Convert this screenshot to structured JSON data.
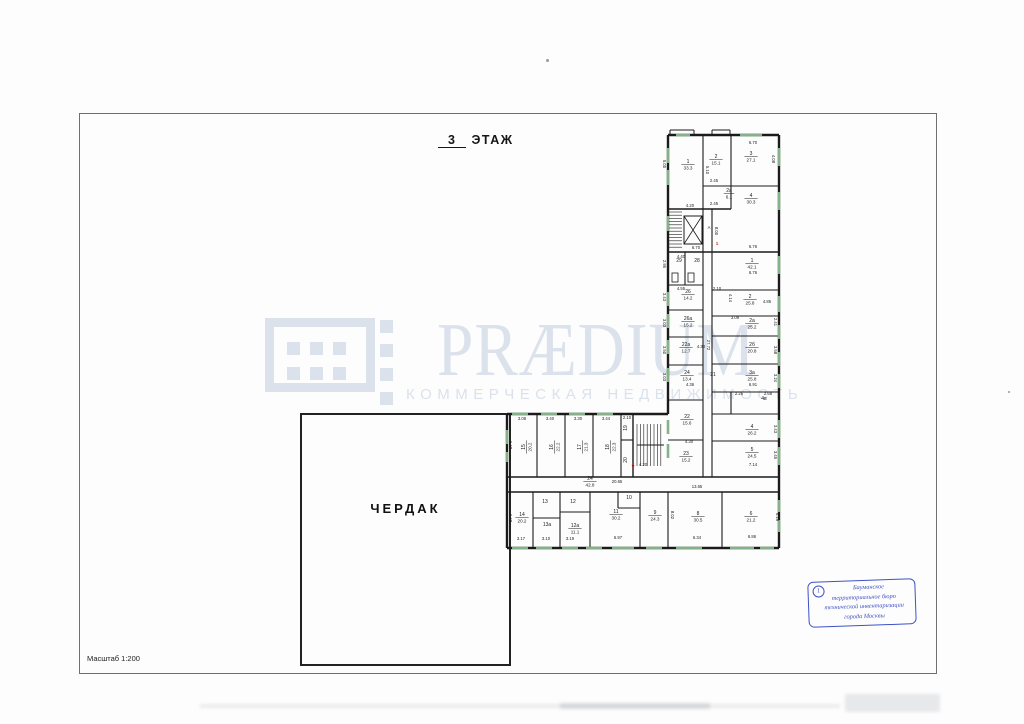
{
  "page": {
    "title_floor": "3",
    "title_word": "ЭТАЖ",
    "scale_label": "Масштаб 1:200",
    "attic_label": "ЧЕРДАК"
  },
  "watermark": {
    "brand": "PRÆDIUM",
    "tagline": "КОММЕРЧЕСКАЯ НЕДВИЖИМОСТЬ",
    "color": "#dbe2ec"
  },
  "stamp": {
    "number": "1",
    "lines": [
      "Бауманское",
      "территориальное бюро",
      "технической инвентаризации",
      "города Москвы"
    ],
    "color": "#3f51c5"
  },
  "plan": {
    "wall_color": "#1b1b1b",
    "window_color": "#86b28a",
    "accent_red": "#c63030",
    "walls": [
      [
        668,
        135,
        779,
        135,
        2.4
      ],
      [
        779,
        135,
        779,
        548,
        2.4
      ],
      [
        779,
        548,
        507,
        548,
        2.4
      ],
      [
        507,
        548,
        507,
        414,
        2.4
      ],
      [
        507,
        414,
        668,
        414,
        2.4
      ],
      [
        668,
        414,
        668,
        135,
        2.4
      ],
      [
        703,
        135,
        703,
        477,
        1.1
      ],
      [
        712,
        209,
        712,
        477,
        1.1
      ],
      [
        731,
        135,
        731,
        209,
        1.1
      ],
      [
        685,
        252,
        685,
        285,
        1.1
      ],
      [
        731,
        392,
        731,
        414,
        1.1
      ],
      [
        668,
        209,
        731,
        209,
        1.4
      ],
      [
        703,
        186,
        779,
        186,
        1.1
      ],
      [
        668,
        252,
        779,
        252,
        1.4
      ],
      [
        668,
        285,
        703,
        285,
        1.1
      ],
      [
        668,
        310,
        703,
        310,
        1.1
      ],
      [
        668,
        337,
        703,
        337,
        1.1
      ],
      [
        668,
        365,
        703,
        365,
        1.1
      ],
      [
        668,
        400,
        703,
        400,
        1.1
      ],
      [
        668,
        440,
        703,
        440,
        1.1
      ],
      [
        712,
        290,
        779,
        290,
        1.1
      ],
      [
        712,
        316,
        779,
        316,
        1.1
      ],
      [
        712,
        336,
        779,
        336,
        1.1
      ],
      [
        712,
        364,
        779,
        364,
        1.1
      ],
      [
        712,
        392,
        779,
        392,
        1.1
      ],
      [
        712,
        414,
        779,
        414,
        1.1
      ],
      [
        712,
        441,
        779,
        441,
        1.1
      ],
      [
        507,
        477,
        779,
        477,
        1.4
      ],
      [
        507,
        492,
        779,
        492,
        1.4
      ],
      [
        537,
        414,
        537,
        477,
        1.1
      ],
      [
        565,
        414,
        565,
        477,
        1.1
      ],
      [
        593,
        414,
        593,
        477,
        1.1
      ],
      [
        621,
        414,
        621,
        477,
        1.1
      ],
      [
        633,
        414,
        633,
        477,
        1.4
      ],
      [
        621,
        440,
        633,
        440,
        1.1
      ],
      [
        637,
        445,
        664,
        445,
        1.0
      ],
      [
        533,
        492,
        533,
        548,
        1.1
      ],
      [
        560,
        492,
        560,
        548,
        1.1
      ],
      [
        590,
        492,
        590,
        548,
        1.1
      ],
      [
        640,
        492,
        640,
        548,
        1.1
      ],
      [
        668,
        492,
        668,
        548,
        1.1
      ],
      [
        722,
        492,
        722,
        548,
        1.1
      ],
      [
        533,
        518,
        560,
        518,
        1.1
      ],
      [
        560,
        512,
        590,
        512,
        1.1
      ],
      [
        618,
        492,
        618,
        508,
        1.1
      ],
      [
        618,
        508,
        640,
        508,
        1.1
      ],
      [
        670,
        130,
        694,
        130,
        1.0
      ],
      [
        670,
        130,
        670,
        135,
        1.0
      ],
      [
        694,
        130,
        694,
        135,
        1.0
      ],
      [
        712,
        130,
        730,
        130,
        1.0
      ],
      [
        712,
        130,
        712,
        135,
        1.0
      ],
      [
        730,
        130,
        730,
        135,
        1.0
      ]
    ],
    "windows": [
      [
        668,
        148,
        668,
        163
      ],
      [
        668,
        170,
        668,
        185
      ],
      [
        668,
        216,
        668,
        231
      ],
      [
        668,
        292,
        668,
        306
      ],
      [
        668,
        314,
        668,
        328
      ],
      [
        668,
        340,
        668,
        354
      ],
      [
        668,
        368,
        668,
        382
      ],
      [
        668,
        420,
        668,
        434
      ],
      [
        668,
        444,
        668,
        458
      ],
      [
        779,
        148,
        779,
        166
      ],
      [
        779,
        192,
        779,
        210
      ],
      [
        779,
        256,
        779,
        274
      ],
      [
        779,
        296,
        779,
        312
      ],
      [
        779,
        325,
        779,
        339
      ],
      [
        779,
        352,
        779,
        366
      ],
      [
        779,
        374,
        779,
        388
      ],
      [
        779,
        420,
        779,
        438
      ],
      [
        779,
        447,
        779,
        465
      ],
      [
        779,
        500,
        779,
        512
      ],
      [
        779,
        520,
        779,
        532
      ],
      [
        676,
        135,
        690,
        135
      ],
      [
        740,
        135,
        762,
        135
      ],
      [
        512,
        414,
        528,
        414
      ],
      [
        541,
        414,
        557,
        414
      ],
      [
        569,
        414,
        585,
        414
      ],
      [
        597,
        414,
        613,
        414
      ],
      [
        512,
        548,
        528,
        548
      ],
      [
        536,
        548,
        552,
        548
      ],
      [
        562,
        548,
        578,
        548
      ],
      [
        586,
        548,
        602,
        548
      ],
      [
        612,
        548,
        634,
        548
      ],
      [
        646,
        548,
        662,
        548
      ],
      [
        676,
        548,
        702,
        548
      ],
      [
        730,
        548,
        754,
        548
      ],
      [
        760,
        548,
        774,
        548
      ],
      [
        507,
        430,
        507,
        444
      ],
      [
        507,
        452,
        507,
        462
      ]
    ],
    "rects": [
      [
        672,
        273,
        6,
        9
      ],
      [
        688,
        273,
        6,
        9
      ]
    ],
    "hatches": [
      {
        "x": 669,
        "y": 212,
        "w": 13,
        "h": 38,
        "step": 3.2,
        "dir": "h"
      },
      {
        "x": 637,
        "y": 424,
        "w": 27,
        "h": 42,
        "step": 3.4,
        "dir": "v"
      }
    ],
    "elevator": {
      "x": 684,
      "y": 216,
      "w": 18,
      "h": 28
    },
    "rooms": [
      [
        688,
        163,
        "1",
        "33.3",
        0
      ],
      [
        716,
        158,
        "2",
        "15.1",
        0
      ],
      [
        729,
        192,
        "2а",
        "6.1",
        0
      ],
      [
        751,
        155,
        "3",
        "27.1",
        0
      ],
      [
        751,
        197,
        "4",
        "30.3",
        0
      ],
      [
        679,
        262,
        "29",
        "",
        0
      ],
      [
        697,
        262,
        "28",
        "",
        0
      ],
      [
        752,
        262,
        "1",
        "42.1",
        0
      ],
      [
        688,
        293,
        "26",
        "14.2",
        0
      ],
      [
        750,
        298,
        "2",
        "25.8",
        0
      ],
      [
        688,
        320,
        "26а",
        "15.2",
        0
      ],
      [
        752,
        322,
        "2а",
        "25.2",
        0
      ],
      [
        686,
        346,
        "22а",
        "12.7",
        0
      ],
      [
        752,
        346,
        "2б",
        "20.8",
        0
      ],
      [
        687,
        374,
        "24",
        "13.4",
        0
      ],
      [
        752,
        374,
        "3а",
        "25.8",
        0
      ],
      [
        764,
        400,
        "4в",
        "",
        0
      ],
      [
        713,
        376,
        "21",
        "",
        0
      ],
      [
        687,
        418,
        "22",
        "15.6",
        0
      ],
      [
        752,
        428,
        "4",
        "26.2",
        0
      ],
      [
        686,
        455,
        "23",
        "15.2",
        0
      ],
      [
        752,
        451,
        "5",
        "24.5",
        0
      ],
      [
        525,
        447,
        "15",
        "20.2",
        -90
      ],
      [
        553,
        447,
        "16",
        "22.2",
        -90
      ],
      [
        581,
        447,
        "17",
        "21.3",
        -90
      ],
      [
        609,
        447,
        "18",
        "22.3",
        -90
      ],
      [
        627,
        428,
        "19",
        "",
        -90
      ],
      [
        627,
        460,
        "20",
        "",
        -90
      ],
      [
        590,
        480,
        "24",
        "42.8",
        0
      ],
      [
        522,
        516,
        "14",
        "20.2",
        0
      ],
      [
        545,
        503,
        "13",
        "",
        0
      ],
      [
        547,
        526,
        "13а",
        "",
        0
      ],
      [
        573,
        503,
        "12",
        "",
        0
      ],
      [
        575,
        527,
        "12а",
        "11.1",
        0
      ],
      [
        616,
        513,
        "11",
        "30.2",
        0
      ],
      [
        629,
        499,
        "10",
        "",
        0
      ],
      [
        655,
        514,
        "9",
        "24.3",
        0
      ],
      [
        698,
        515,
        "8",
        "30.5",
        0
      ],
      [
        751,
        515,
        "6",
        "21.2",
        0
      ]
    ],
    "dims": [
      [
        753,
        144,
        "6.70",
        0
      ],
      [
        772,
        159,
        "4.08",
        90
      ],
      [
        663,
        164,
        "5.00",
        90
      ],
      [
        714,
        182,
        "2.45",
        0
      ],
      [
        706,
        170,
        "5.10",
        90
      ],
      [
        714,
        205,
        "2.45",
        0
      ],
      [
        690,
        207,
        "4.20",
        0
      ],
      [
        696,
        249,
        "6.70",
        0
      ],
      [
        753,
        248,
        "6.76",
        0
      ],
      [
        681,
        258,
        "4.40",
        0
      ],
      [
        663,
        264,
        "2.95",
        90
      ],
      [
        709,
        229,
        "А",
        0
      ],
      [
        715,
        231,
        "8.00",
        90
      ],
      [
        753,
        274,
        "6.76",
        0
      ],
      [
        681,
        290,
        "4.55",
        0
      ],
      [
        717,
        290,
        "2.10",
        0
      ],
      [
        729,
        298,
        "4.14",
        90
      ],
      [
        767,
        303,
        "4.85",
        0
      ],
      [
        735,
        319,
        "3.09",
        0
      ],
      [
        774,
        322,
        "2.41",
        90
      ],
      [
        707,
        345,
        "27.72",
        90
      ],
      [
        701,
        348,
        "4.33",
        0
      ],
      [
        663,
        297,
        "3.43",
        90
      ],
      [
        663,
        323,
        "3.03",
        90
      ],
      [
        663,
        350,
        "3.50",
        90
      ],
      [
        774,
        350,
        "3.58",
        90
      ],
      [
        663,
        377,
        "3.03",
        90
      ],
      [
        774,
        378,
        "3.24",
        90
      ],
      [
        753,
        386,
        "6.91",
        0
      ],
      [
        739,
        395,
        "2.25",
        0
      ],
      [
        768,
        395,
        "2.68",
        0
      ],
      [
        690,
        386,
        "4.36",
        0
      ],
      [
        689,
        443,
        "4.30",
        0
      ],
      [
        774,
        429,
        "3.43",
        90
      ],
      [
        774,
        455,
        "3.45",
        90
      ],
      [
        753,
        466,
        "7.14",
        0
      ],
      [
        697,
        488,
        "13.65",
        0
      ],
      [
        617,
        483,
        "20.65",
        0
      ],
      [
        643,
        466,
        "4.20",
        0
      ],
      [
        522,
        420,
        "3.08",
        0
      ],
      [
        550,
        420,
        "3.40",
        0
      ],
      [
        578,
        420,
        "3.30",
        0
      ],
      [
        606,
        420,
        "3.44",
        0
      ],
      [
        627,
        419,
        "2.10",
        0
      ],
      [
        509,
        445,
        "6.48",
        90
      ],
      [
        509,
        518,
        "6.48",
        90
      ],
      [
        521,
        540,
        "3.17",
        0
      ],
      [
        546,
        540,
        "3.10",
        0
      ],
      [
        570,
        540,
        "3.19",
        0
      ],
      [
        618,
        539,
        "6.97",
        0
      ],
      [
        697,
        539,
        "6.34",
        0
      ],
      [
        752,
        538,
        "6.86",
        0
      ],
      [
        776,
        517,
        "6.19",
        90
      ],
      [
        671,
        515,
        "8.02",
        90
      ]
    ],
    "marks": [
      [
        633,
        467,
        "б"
      ],
      [
        717,
        245,
        "1"
      ]
    ]
  }
}
